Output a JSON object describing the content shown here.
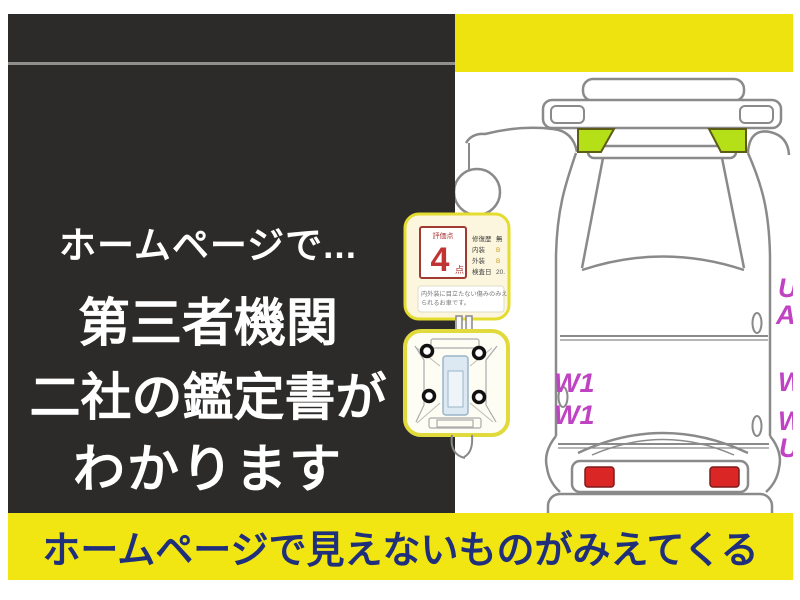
{
  "left_panel": {
    "lines": [
      "ホームページで...",
      "第三者機関",
      "二社の鑑定書が",
      "わかります"
    ]
  },
  "bottom_banner": {
    "text": "ホームページで見えないものがみえてくる"
  },
  "inspection_card": {
    "score_label": "評価点",
    "score": "4",
    "score_unit": "点",
    "fields": [
      {
        "label": "修復歴",
        "value": "無"
      },
      {
        "label": "内装",
        "value": "B"
      },
      {
        "label": "外装",
        "value": "B"
      },
      {
        "label": "検査日",
        "value": "20."
      }
    ],
    "note_lines": [
      "内外装に目立たない傷みのみえ",
      "られるお車です。"
    ]
  },
  "diagram_marks": {
    "left_labels": [
      "W1",
      "W1"
    ],
    "right_labels": [
      "U",
      "A",
      "W",
      "W",
      "U"
    ]
  },
  "colors": {
    "panel_dark": "#2c2b29",
    "yellow": "#eee30e",
    "navy_text": "#1f2f7c",
    "highlight_green": "#b5df17",
    "tail_red": "#da2726",
    "mark_magenta": "#c043c3",
    "score_red": "#c13434"
  }
}
